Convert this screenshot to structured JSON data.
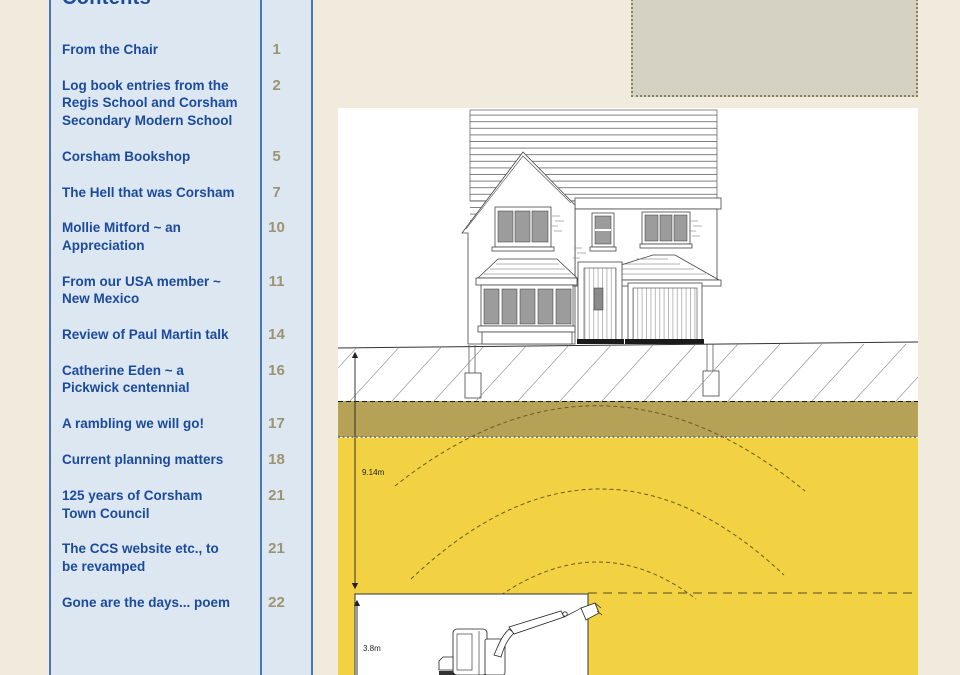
{
  "toc": {
    "heading": "Contents",
    "items": [
      {
        "title": "From the Chair",
        "page": "1"
      },
      {
        "title": "Log book entries from the\nRegis School and Corsham\nSecondary Modern School",
        "page": "2"
      },
      {
        "title": "Corsham Bookshop",
        "page": "5"
      },
      {
        "title": "The Hell that was Corsham",
        "page": "7"
      },
      {
        "title": "Mollie Mitford ~  an\nAppreciation",
        "page": "10"
      },
      {
        "title": "From our USA member ~\nNew Mexico",
        "page": "11"
      },
      {
        "title": "Review of Paul Martin talk",
        "page": "14"
      },
      {
        "title": "Catherine Eden ~  a\nPickwick centennial",
        "page": "16"
      },
      {
        "title": "A rambling we will go!",
        "page": "17"
      },
      {
        "title": "Current planning matters",
        "page": "18"
      },
      {
        "title": "125 years of Corsham\nTown Council",
        "page": "21"
      },
      {
        "title": "The CCS website etc., to\nbe revamped",
        "page": "21"
      },
      {
        "title": "Gone are the days... poem",
        "page": "22"
      }
    ]
  },
  "diagram": {
    "depth_label": "9.14m",
    "machine_height_label": "3.8m"
  },
  "colors": {
    "page_background": "#f0ebdd",
    "toc_panel_background": "#dce7f2",
    "toc_border_blue": "#4878b4",
    "toc_title_blue": "#1c4a9c",
    "toc_page_number_olive": "#9b9371",
    "photo_placeholder_grey": "#d5d2c3",
    "soil_band_olive": "#b5a257",
    "rock_layer_yellow": "#f2d143"
  }
}
